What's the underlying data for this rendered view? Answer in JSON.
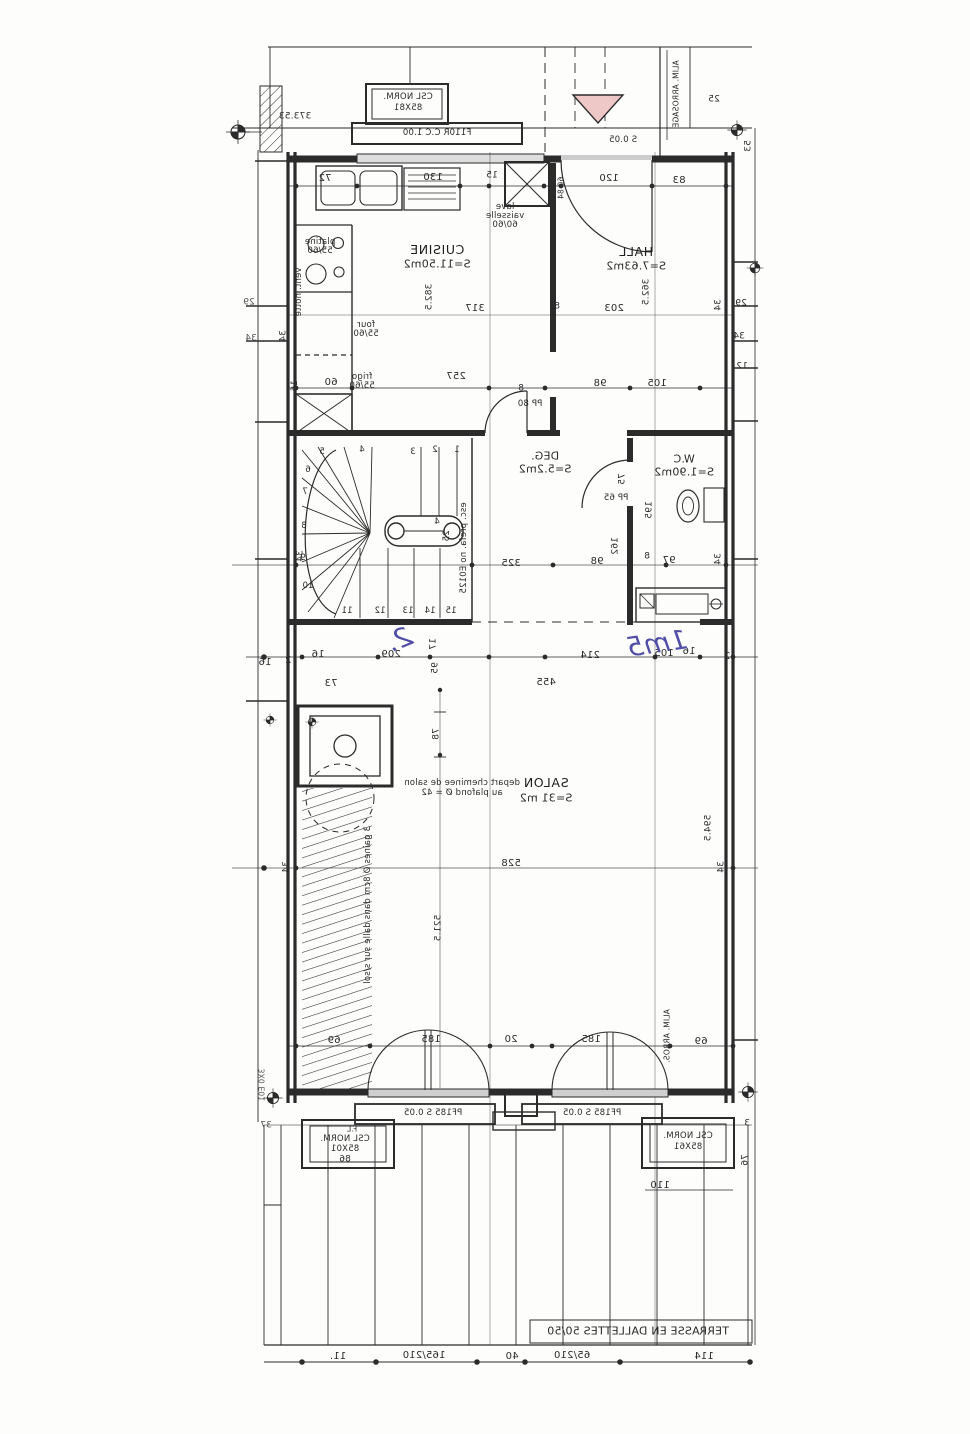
{
  "colors": {
    "ink": "#2b2b2b",
    "blue": "#504ea6",
    "pink": "#eec8c6",
    "paper": "#fdfdfc",
    "sill": "#cfcfcf"
  },
  "top": {
    "csl1": "CSL NORM.",
    "csl2": "85X81",
    "window": "F110R C.C 1.00",
    "seuil": "S 0.05",
    "arrosage": "ALIM. ARROSAGE",
    "elev": "373.53",
    "d25": "25",
    "d53": "53"
  },
  "kitchen": {
    "name": "CUISINE",
    "area": "S=11.50m2",
    "lave1": "lave",
    "lave2": "vaisselle",
    "lave3": "60/60",
    "platine1": "platine",
    "platine2": "55/60",
    "four1": "four",
    "four2": "55/60",
    "frigo1": "frigo",
    "frigo2": "55/60",
    "vent_hotte": "vent. hotte",
    "pp80": "PP 80",
    "dims": {
      "d72": "72",
      "d130": "130",
      "d15": "15",
      "d8": "8",
      "d6084": "60 84",
      "d60": "60",
      "d16": "16",
      "d257": "257",
      "d382": "382.5",
      "d317": "317",
      "d8b": "8",
      "d8c": "8"
    }
  },
  "hall": {
    "name": "HALL",
    "area": "S=7.63m2",
    "dims": {
      "d120": "120",
      "d83": "83",
      "d203": "203",
      "d362": "362.5",
      "d98": "98",
      "d105": "105"
    }
  },
  "deg": {
    "name": "DEG.",
    "area": "S=5.2m2",
    "dims": {
      "d325": "325",
      "d98": "98",
      "d17": "17",
      "d95": "95"
    }
  },
  "wc": {
    "name": "W.C",
    "area": "S=1.90m2",
    "pp65": "PP 65",
    "dims": {
      "d75": "75",
      "d195": "195",
      "d162": "162",
      "d8": "8",
      "d97": "97"
    }
  },
  "stair": {
    "note": "esc. prefa. no E0125",
    "d4": "4",
    "d25": "25",
    "steps": {
      "n1": "1",
      "n2": "2",
      "n3": "3",
      "n4": "4",
      "n5": "5",
      "n6": "6",
      "n7": "7",
      "n8": "8",
      "n9": "9",
      "n10": "10",
      "n11": "11",
      "n12": "12",
      "n13": "13",
      "n14": "14",
      "n15": "15"
    }
  },
  "mid": {
    "d16a": "16",
    "d209": "209",
    "d214": "214",
    "d105": "105",
    "d16b": "16",
    "d2a": "2",
    "d455": "455",
    "d73": "73",
    "d16c": "16",
    "d2b": "2"
  },
  "salon": {
    "name": "SALON",
    "area": "S=31 m2",
    "chem1": "depart cheminee de salon",
    "chem2": "au plafond Ø = 42",
    "gaines": "3 gaines Ø 8cm dans dalle sur s/sol",
    "arros": "ALIM. ARROS.",
    "dims": {
      "d78": "78",
      "d594": "594.5",
      "d528": "528",
      "d5215": "521.5",
      "d69a": "69",
      "d185a": "185",
      "d20": "20",
      "d185b": "185",
      "d69b": "69"
    }
  },
  "bottom": {
    "pf1": "PF185 S 0.05",
    "pf2": "PF185 S 0.05",
    "fl": "F.L",
    "csl_l1": "CSL NORM.",
    "csl_l2": "85X01",
    "d86": "86",
    "csl_r1": "CSL NORM.",
    "csl_r2": "85X61",
    "d110": "110",
    "d76": "76",
    "d3": "3",
    "d37": "37",
    "mark": "3X0 E01"
  },
  "terrace": {
    "label": "TERRASSE EN DALLETTES 50/50",
    "dims": {
      "b11": "11.",
      "b165": "165/210",
      "b40": "40",
      "b65": "65/210",
      "b114": "114"
    }
  },
  "margins": {
    "l29": "29",
    "l34": "34",
    "r29": "29",
    "r34": "34",
    "r12": "12",
    "r34b": "34",
    "l34b": "34",
    "r34c": "34",
    "l34c": "34",
    "r34d": "34",
    "l34d": "34"
  },
  "handwriting": {
    "a": "2.",
    "b": "1m5"
  }
}
